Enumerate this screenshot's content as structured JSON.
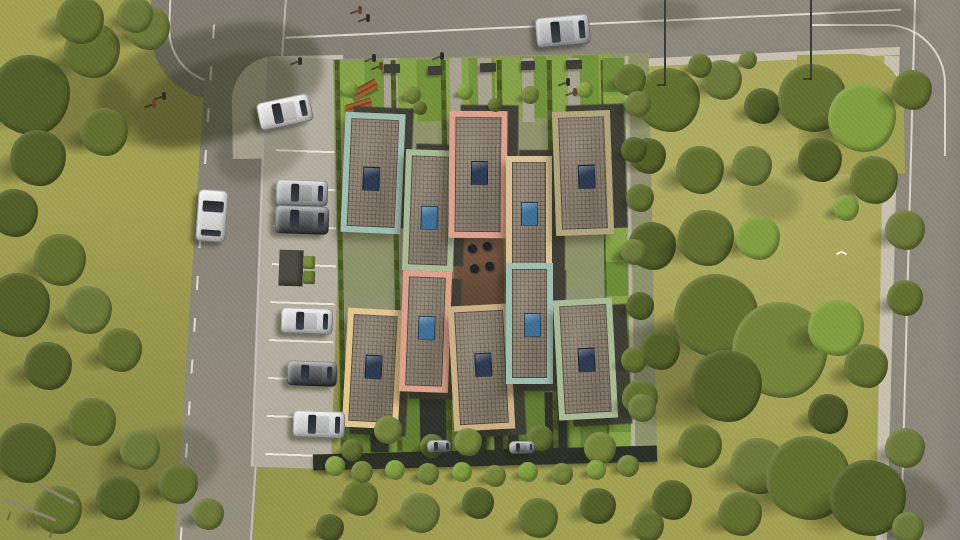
{
  "scene": {
    "title": "aerial-architectural-render-residential-complex",
    "canvas": {
      "width": 960,
      "height": 540
    },
    "palette": {
      "grass": "#a3a252",
      "road": "#8d887c",
      "road_dark": "#837e73",
      "sidewalk": "#c9c2b1",
      "curb_line": "#ece8da",
      "parking": "#b5afa0",
      "complex_base": "#8d9466",
      "front_garden": "#7d9c40",
      "south_garden": "#6c8836",
      "path": "#9b9480",
      "hedge": "#49571f",
      "wall_dark": "#2b2e25",
      "struct_dark": "#2e312a",
      "courtyard": "#6a4e3b",
      "roof": "#8d8272",
      "building_side": "#3f3e35",
      "shed": "#4b4b43",
      "bin_green": "#7a9038",
      "bench_wood": "#a05c30",
      "skylight_navy": "#2b3950",
      "skylight_blue": "#3e7096"
    },
    "roads": {
      "top_road": {
        "x": 228,
        "y": -52,
        "w": 762,
        "h": 112,
        "rot": -2.6
      },
      "top_sidewalk": {
        "x": 228,
        "y": 52,
        "w": 762,
        "h": 16,
        "rot": -2.6
      },
      "left_road": {
        "x": 192,
        "y": -16,
        "w": 78,
        "h": 580,
        "rot": 3.7
      },
      "corner_road_patch": {
        "x": 150,
        "y": -30,
        "w": 130,
        "h": 130,
        "rot": 2,
        "radius": 70
      },
      "right_road": {
        "x": 894,
        "y": -20,
        "w": 130,
        "h": 580,
        "rot": 1.5
      },
      "right_sidewalk": {
        "x": 880,
        "y": 56,
        "w": 16,
        "h": 504,
        "rot": 1
      },
      "corner_tl_sidewalk": {
        "x": 232,
        "y": 56,
        "w": 112,
        "h": 102,
        "rot": -1,
        "radius": 44
      },
      "corner_tr_grass": {
        "x": 798,
        "y": 54,
        "w": 106,
        "h": 120,
        "rot": -1,
        "radius": 48
      },
      "center_line_offset_from_bottom": 36
    },
    "parking": {
      "strip": {
        "x": 258,
        "y": 58,
        "w": 80,
        "h": 410,
        "rot": 2
      },
      "lines_top": 92,
      "lines_gap": 38,
      "shed": {
        "x": 279,
        "y": 250,
        "w": 24,
        "h": 36,
        "rot": 2
      },
      "bins": [
        [
          303,
          256,
          12,
          13
        ],
        [
          303,
          271,
          12,
          13
        ]
      ]
    },
    "complex": {
      "base": {
        "x": 337,
        "y": 56,
        "w": 316,
        "h": 410,
        "rot": -1.2
      },
      "front_garden": {
        "x": 339,
        "y": 58,
        "w": 272,
        "h": 62,
        "rot": -1.5
      },
      "front_paths": [
        [
          384,
          58,
          14,
          64
        ],
        [
          450,
          58,
          12,
          64
        ],
        [
          478,
          58,
          14,
          64
        ],
        [
          522,
          58,
          12,
          64
        ],
        [
          568,
          58,
          12,
          64
        ]
      ],
      "col_paths": [
        [
          398,
          118,
          12,
          330
        ],
        [
          448,
          118,
          12,
          330
        ],
        [
          503,
          118,
          12,
          330
        ],
        [
          554,
          118,
          12,
          330
        ]
      ],
      "hedges": [
        [
          338,
          60,
          5,
          398
        ],
        [
          394,
          60,
          5,
          392
        ],
        [
          444,
          60,
          5,
          392
        ],
        [
          500,
          60,
          5,
          392
        ],
        [
          550,
          60,
          5,
          392
        ],
        [
          604,
          60,
          5,
          392
        ]
      ],
      "south_garden": {
        "x": 340,
        "y": 390,
        "w": 272,
        "h": 62,
        "rot": -1
      },
      "south_structs": [
        [
          370,
          396,
          18,
          56
        ],
        [
          420,
          392,
          26,
          60
        ],
        [
          468,
          390,
          18,
          62
        ],
        [
          494,
          390,
          24,
          64
        ],
        [
          545,
          392,
          22,
          60
        ]
      ],
      "bottom_wall": {
        "x": 313,
        "y": 450,
        "w": 344,
        "h": 16,
        "rot": -1.5
      },
      "right_strip": {
        "x": 606,
        "y": 58,
        "w": 22,
        "h": 400,
        "rot": -1
      },
      "right_wall_line": {
        "x": 628,
        "y": 56,
        "w": 4,
        "h": 404,
        "rot": -1
      },
      "courtyard": {
        "x": 452,
        "y": 228,
        "w": 54,
        "h": 84,
        "rot": -1,
        "tables": [
          [
            16,
            16
          ],
          [
            31,
            14
          ],
          [
            18,
            36
          ],
          [
            33,
            34
          ]
        ]
      }
    },
    "buildings": [
      {
        "id": "b1",
        "x": 343,
        "y": 113,
        "w": 60,
        "h": 120,
        "rot": 2.5,
        "trim": "#9fc0b3",
        "sky": [
          20,
          54
        ],
        "sky_color": "#2b3950"
      },
      {
        "id": "b2",
        "x": 404,
        "y": 150,
        "w": 51,
        "h": 121,
        "rot": 2,
        "trim": "#abbc98",
        "sky": [
          17,
          56
        ],
        "sky_color": "#3e7096"
      },
      {
        "id": "b3",
        "x": 449,
        "y": 111,
        "w": 58,
        "h": 127,
        "rot": 0.5,
        "trim": "#dfa28d",
        "sky": [
          22,
          50
        ],
        "sky_color": "#2b3950"
      },
      {
        "id": "b4",
        "x": 506,
        "y": 156,
        "w": 46,
        "h": 124,
        "rot": 0,
        "trim": "#dcc496",
        "sky": [
          15,
          46
        ],
        "sky_color": "#3e7096"
      },
      {
        "id": "b5",
        "x": 554,
        "y": 111,
        "w": 58,
        "h": 124,
        "rot": -2,
        "trim": "#b3a67c",
        "sky": [
          24,
          54
        ],
        "sky_color": "#2b3950"
      },
      {
        "id": "b6",
        "x": 345,
        "y": 309,
        "w": 56,
        "h": 119,
        "rot": 3,
        "trim": "#e4c98f",
        "sky": [
          20,
          46
        ],
        "sky_color": "#2b3950"
      },
      {
        "id": "b7",
        "x": 401,
        "y": 271,
        "w": 49,
        "h": 121,
        "rot": 2,
        "trim": "#dfa28d",
        "sky": [
          17,
          45
        ],
        "sky_color": "#3e7096"
      },
      {
        "id": "b8",
        "x": 451,
        "y": 305,
        "w": 61,
        "h": 125,
        "rot": -3,
        "trim": "#cdb285",
        "sky": [
          24,
          48
        ],
        "sky_color": "#2b3950"
      },
      {
        "id": "b9",
        "x": 506,
        "y": 263,
        "w": 47,
        "h": 121,
        "rot": 0,
        "trim": "#9fc0b3",
        "sky": [
          18,
          50
        ],
        "sky_color": "#3e7096"
      },
      {
        "id": "b10",
        "x": 556,
        "y": 299,
        "w": 59,
        "h": 120,
        "rot": -3,
        "trim": "#abbc98",
        "sky": [
          22,
          49
        ],
        "sky_color": "#2b3950"
      }
    ],
    "sky_size": [
      15,
      22
    ],
    "trees": [
      [
        30,
        95,
        40,
        "#525f28"
      ],
      [
        92,
        50,
        28,
        "#62702f"
      ],
      [
        148,
        28,
        22,
        "#6d7a3a"
      ],
      [
        80,
        20,
        24,
        "#62702f"
      ],
      [
        135,
        15,
        18,
        "#6d7a3a"
      ],
      [
        38,
        158,
        28,
        "#525f28"
      ],
      [
        104,
        132,
        24,
        "#62702f"
      ],
      [
        14,
        213,
        24,
        "#525f28"
      ],
      [
        60,
        260,
        26,
        "#62702f"
      ],
      [
        18,
        305,
        32,
        "#525f28"
      ],
      [
        88,
        310,
        24,
        "#6d7a3a"
      ],
      [
        120,
        350,
        22,
        "#62702f"
      ],
      [
        48,
        366,
        24,
        "#525f28"
      ],
      [
        92,
        422,
        24,
        "#62702f"
      ],
      [
        26,
        453,
        30,
        "#525f28"
      ],
      [
        140,
        450,
        20,
        "#6d7a3a"
      ],
      [
        178,
        484,
        20,
        "#62702f"
      ],
      [
        118,
        498,
        22,
        "#525f28"
      ],
      [
        58,
        510,
        24,
        "#62702f"
      ],
      [
        208,
        514,
        16,
        "#6d7a3a"
      ],
      [
        668,
        100,
        32,
        "#62702f"
      ],
      [
        722,
        80,
        20,
        "#6d7a3a"
      ],
      [
        762,
        106,
        18,
        "#525f28"
      ],
      [
        812,
        98,
        34,
        "#62702f"
      ],
      [
        862,
        118,
        34,
        "#82a03f"
      ],
      [
        912,
        90,
        20,
        "#62702f"
      ],
      [
        648,
        156,
        18,
        "#525f28"
      ],
      [
        700,
        170,
        24,
        "#62702f"
      ],
      [
        752,
        166,
        20,
        "#6d7a3a"
      ],
      [
        820,
        160,
        22,
        "#525f28"
      ],
      [
        874,
        180,
        24,
        "#62702f"
      ],
      [
        905,
        230,
        20,
        "#6d7a3a"
      ],
      [
        846,
        208,
        13,
        "#82a03f"
      ],
      [
        652,
        246,
        24,
        "#525f28"
      ],
      [
        706,
        238,
        28,
        "#62702f"
      ],
      [
        758,
        238,
        22,
        "#82a03f"
      ],
      [
        905,
        298,
        18,
        "#62702f"
      ],
      [
        716,
        316,
        42,
        "#62702f"
      ],
      [
        780,
        350,
        48,
        "#74853a"
      ],
      [
        726,
        386,
        36,
        "#525f28"
      ],
      [
        836,
        328,
        28,
        "#82a03f"
      ],
      [
        866,
        366,
        22,
        "#62702f"
      ],
      [
        660,
        350,
        20,
        "#525f28"
      ],
      [
        640,
        398,
        18,
        "#62702f"
      ],
      [
        828,
        414,
        20,
        "#4a5526"
      ],
      [
        700,
        446,
        22,
        "#62702f"
      ],
      [
        758,
        466,
        28,
        "#6d7a3a"
      ],
      [
        808,
        478,
        42,
        "#62702f"
      ],
      [
        868,
        498,
        38,
        "#525f28"
      ],
      [
        905,
        448,
        20,
        "#6d7a3a"
      ],
      [
        672,
        500,
        20,
        "#525f28"
      ],
      [
        740,
        514,
        22,
        "#62702f"
      ],
      [
        908,
        528,
        16,
        "#6d7a3a"
      ],
      [
        630,
        80,
        16,
        "#62702f"
      ],
      [
        638,
        104,
        13,
        "#6d7a3a"
      ],
      [
        634,
        150,
        13,
        "#525f28"
      ],
      [
        640,
        198,
        14,
        "#62702f"
      ],
      [
        634,
        252,
        13,
        "#6d7a3a"
      ],
      [
        640,
        306,
        14,
        "#525f28"
      ],
      [
        634,
        360,
        13,
        "#62702f"
      ],
      [
        642,
        408,
        14,
        "#6d7a3a"
      ],
      [
        360,
        498,
        18,
        "#62702f"
      ],
      [
        420,
        513,
        20,
        "#6d7a3a"
      ],
      [
        478,
        503,
        16,
        "#525f28"
      ],
      [
        538,
        518,
        20,
        "#62702f"
      ],
      [
        598,
        506,
        18,
        "#525f28"
      ],
      [
        648,
        526,
        16,
        "#62702f"
      ],
      [
        330,
        528,
        14,
        "#525f28"
      ],
      [
        388,
        430,
        14,
        "#74853a"
      ],
      [
        432,
        446,
        12,
        "#62702f"
      ],
      [
        468,
        442,
        14,
        "#74853a"
      ],
      [
        540,
        438,
        13,
        "#62702f"
      ],
      [
        600,
        448,
        16,
        "#74853a"
      ],
      [
        352,
        450,
        11,
        "#62702f"
      ],
      [
        350,
        90,
        8,
        "#82a03f"
      ],
      [
        412,
        95,
        9,
        "#74853a"
      ],
      [
        465,
        92,
        8,
        "#82a03f"
      ],
      [
        530,
        95,
        9,
        "#74853a"
      ],
      [
        585,
        90,
        8,
        "#82a03f"
      ],
      [
        420,
        108,
        7,
        "#62702f"
      ],
      [
        495,
        105,
        7,
        "#62702f"
      ],
      [
        700,
        66,
        12,
        "#62702f"
      ],
      [
        748,
        60,
        9,
        "#6d7a3a"
      ],
      [
        335,
        466,
        10,
        "#82a03f"
      ],
      [
        362,
        472,
        11,
        "#74853a"
      ],
      [
        395,
        470,
        10,
        "#82a03f"
      ],
      [
        428,
        474,
        11,
        "#74853a"
      ],
      [
        462,
        472,
        10,
        "#82a03f"
      ],
      [
        495,
        476,
        11,
        "#74853a"
      ],
      [
        528,
        472,
        10,
        "#82a03f"
      ],
      [
        562,
        474,
        11,
        "#74853a"
      ],
      [
        596,
        470,
        10,
        "#82a03f"
      ],
      [
        628,
        466,
        11,
        "#74853a"
      ]
    ],
    "ground_shadows": [
      [
        95,
        30,
        230,
        110,
        -14,
        0.32
      ],
      [
        5,
        65,
        130,
        80,
        8,
        0.28
      ],
      [
        130,
        60,
        170,
        80,
        -18,
        0.3
      ],
      [
        215,
        120,
        90,
        60,
        -20,
        0.22
      ],
      [
        600,
        325,
        150,
        100,
        6,
        0.28
      ],
      [
        828,
        0,
        90,
        34,
        0,
        0.22
      ],
      [
        640,
        0,
        60,
        28,
        0,
        0.2
      ],
      [
        838,
        468,
        110,
        60,
        14,
        0.25
      ],
      [
        740,
        180,
        60,
        40,
        10,
        0.18
      ],
      [
        100,
        430,
        120,
        70,
        -12,
        0.22
      ]
    ],
    "cars": [
      {
        "name": "car-driving-top-road",
        "x": 536,
        "y": 16,
        "w": 54,
        "h": 30,
        "rot": -5,
        "color": "#b8babb"
      },
      {
        "name": "car-driving-left-road",
        "x": 197,
        "y": 190,
        "w": 30,
        "h": 52,
        "rot": 4,
        "color": "#e2e3e1",
        "vertical": true
      },
      {
        "name": "car-parked-corner",
        "x": 258,
        "y": 98,
        "w": 54,
        "h": 28,
        "rot": -12,
        "color": "#e6e7e5"
      },
      {
        "name": "car-parked-1",
        "x": 276,
        "y": 180,
        "w": 52,
        "h": 26,
        "rot": 2,
        "color": "#a9abac"
      },
      {
        "name": "car-parked-2",
        "x": 275,
        "y": 206,
        "w": 54,
        "h": 28,
        "rot": 2,
        "color": "#3a3c3e"
      },
      {
        "name": "car-parked-3",
        "x": 281,
        "y": 308,
        "w": 52,
        "h": 26,
        "rot": 2,
        "color": "#dcdedd"
      },
      {
        "name": "car-parked-4",
        "x": 287,
        "y": 361,
        "w": 50,
        "h": 25,
        "rot": 2,
        "color": "#36383b"
      },
      {
        "name": "car-parked-5",
        "x": 293,
        "y": 411,
        "w": 52,
        "h": 27,
        "rot": 2,
        "color": "#d8dad9"
      },
      {
        "name": "car-carport-1",
        "x": 427,
        "y": 440,
        "w": 24,
        "h": 13,
        "rot": -1,
        "color": "#6f7173"
      },
      {
        "name": "car-carport-2",
        "x": 509,
        "y": 441,
        "w": 26,
        "h": 13,
        "rot": -1,
        "color": "#77797b"
      }
    ],
    "people": [
      [
        358,
        6
      ],
      [
        366,
        14
      ],
      [
        372,
        54
      ],
      [
        379,
        62
      ],
      [
        440,
        52
      ],
      [
        566,
        78
      ],
      [
        573,
        88
      ],
      [
        298,
        57
      ],
      [
        162,
        92
      ],
      [
        152,
        100
      ]
    ],
    "poles": [
      [
        664,
        0,
        86
      ],
      [
        810,
        0,
        80
      ]
    ],
    "benches": [
      [
        352,
        84,
        26,
        10,
        -28
      ],
      [
        346,
        101,
        26,
        9,
        -18
      ]
    ],
    "entry_boxes": [
      [
        384,
        64,
        16,
        9
      ],
      [
        428,
        66,
        14,
        9
      ],
      [
        480,
        63,
        16,
        9
      ],
      [
        521,
        61,
        14,
        9
      ],
      [
        566,
        60,
        16,
        9
      ]
    ],
    "fence": {
      "rails": [
        [
          0,
          508,
          58,
          3,
          22
        ],
        [
          36,
          492,
          40,
          3,
          28
        ]
      ],
      "posts": [
        [
          8,
          512
        ],
        [
          28,
          520
        ],
        [
          50,
          530
        ]
      ]
    },
    "bird": {
      "x": 836,
      "y": 252
    }
  }
}
